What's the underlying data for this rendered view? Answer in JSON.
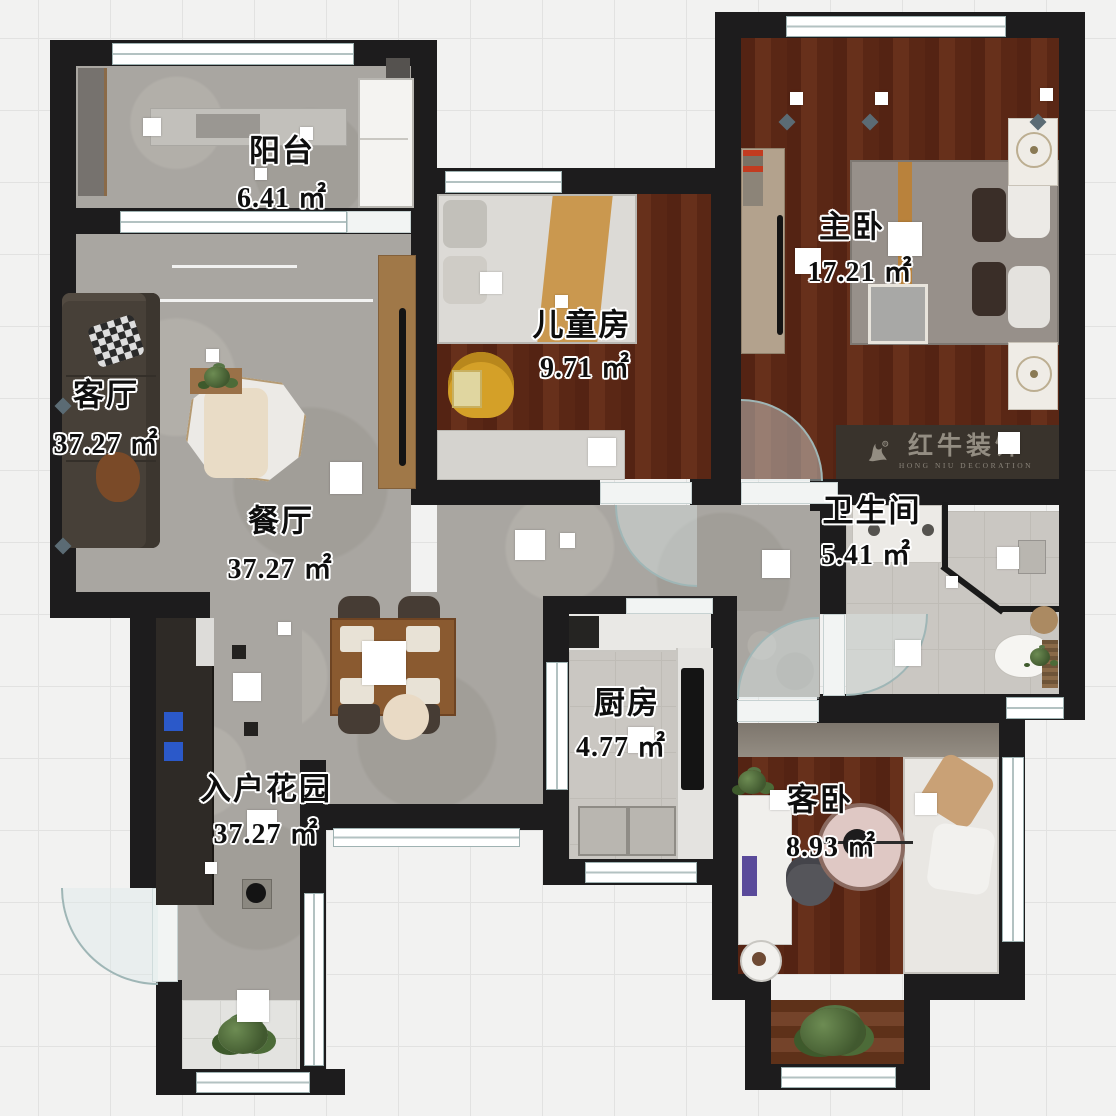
{
  "rooms": [
    {
      "id": "balcony",
      "name": "阳台",
      "area": "6.41 ㎡"
    },
    {
      "id": "living-room",
      "name": "客厅",
      "area": "37.27 ㎡"
    },
    {
      "id": "children-room",
      "name": "儿童房",
      "area": "9.71 ㎡"
    },
    {
      "id": "master-bedroom",
      "name": "主卧",
      "area": "17.21 ㎡"
    },
    {
      "id": "dining-room",
      "name": "餐厅",
      "area": "37.27 ㎡"
    },
    {
      "id": "bathroom",
      "name": "卫生间",
      "area": "5.41 ㎡"
    },
    {
      "id": "kitchen",
      "name": "厨房",
      "area": "4.77 ㎡"
    },
    {
      "id": "entry-garden",
      "name": "入户花园",
      "area": "37.27 ㎡"
    },
    {
      "id": "guest-bedroom",
      "name": "客卧",
      "area": "8.93 ㎡"
    }
  ],
  "logo": {
    "name_cn": "红牛装饰",
    "name_en": "HONG NIU DECORATION"
  },
  "colors": {
    "wall": "#1d1c1d",
    "wood_floor": "#5e2817",
    "concrete_floor": "#a9a6a1",
    "tile_floor": "#cac7c2",
    "logo_band": "#39332c",
    "accent_blue": "#2b59c9"
  }
}
